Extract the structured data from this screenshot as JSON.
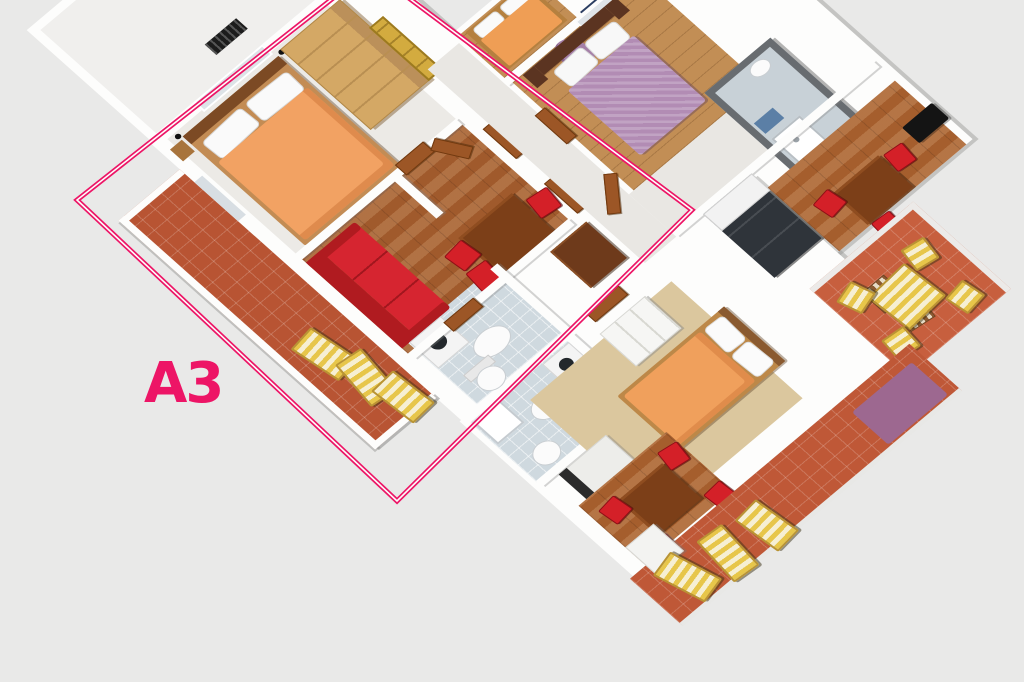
{
  "scene": {
    "type": "3d-floor-plan-render",
    "apartment_label": "A3",
    "outline_color": "#ed1566",
    "background_color": "#e9e9e8"
  },
  "palette": {
    "wall_white": "#fdfdfc",
    "wall_shadow": "#c9c9c7",
    "balcony_tile": "#b85433",
    "terrace_tile": "#bf5837",
    "terrace_tile_bright": "#c75f3e",
    "living_wood_tile": "#a05a2c",
    "dining_wood_tile": "#a55e2d",
    "plank_wood_floor": "#c28e55",
    "bedroom_floor": "#eceae6",
    "bathroom_tile": "#cfd9df",
    "carpet_beige": "#dbc79e",
    "orange_bed": "#f2a263",
    "studio_orange_bed": "#f0a05c",
    "purple_bed": "#b28cb4",
    "red_sofa": "#d62530",
    "red_chair": "#d42028",
    "table_wood": "#7c3f18",
    "bed_frame_wood": "#c38c54",
    "wardrobe_wood": "#d4a865",
    "dark_wardrobe": "#6e3a1b",
    "yellow_entrance_door": "#d3ab3f",
    "interior_door": "#9c5626",
    "kitchen_dark": "#2f343a",
    "shower_room_wall": "#686c70",
    "navy_landing": "#2c3e62",
    "lounger_yellow": "#e7c64a",
    "lounger_cream": "#f6efd3",
    "purple_mat": "#9d6890",
    "curtain": "#a580a8",
    "tv_black": "#141414"
  },
  "elements": {
    "apartment_outline": "A3 apartment boundary",
    "rooms": [
      "neighbor-unit",
      "bedroom",
      "living-room",
      "bathroom",
      "balcony-terrace",
      "hallway",
      "second-bedroom",
      "purple-bedroom",
      "shower-room",
      "kitchen",
      "dining-area",
      "second-bathroom",
      "studio-bedroom",
      "side-terrace",
      "bottom-terrace"
    ],
    "furniture": [
      "double-bed-orange",
      "wardrobe",
      "red-sofa",
      "dining-table",
      "red-chairs",
      "dark-wardrobe",
      "washing-machine",
      "sink",
      "toilet",
      "sun-loungers",
      "purple-double-bed",
      "curtain",
      "shower-tray",
      "kitchen-cabinets",
      "tv",
      "white-wardrobe",
      "kitchen-counter",
      "striped-terrace-set",
      "purple-mat",
      "entrance-door",
      "interior-doors"
    ]
  }
}
